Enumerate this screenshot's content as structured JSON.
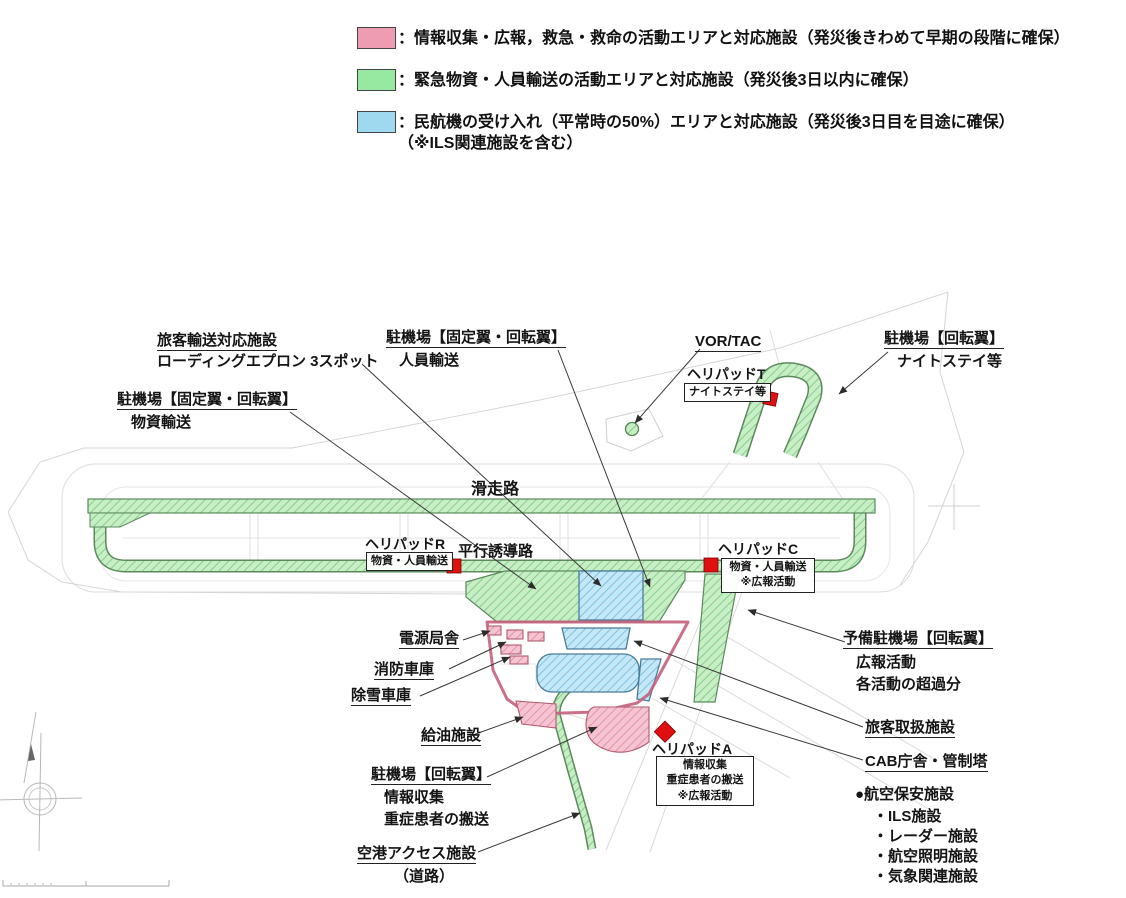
{
  "colors": {
    "pink": "#ee9cb2",
    "green": "#97e8a0",
    "blue": "#9ed9f0",
    "red": "#e01010",
    "boundary": "#c4607c"
  },
  "legend": {
    "items": [
      {
        "color": "#ee9cb2",
        "label": "：情報収集・広報，救急・救命の活動エリアと対応施設（発災後きわめて早期の段階に確保）"
      },
      {
        "color": "#97e8a0",
        "label": "：緊急物資・人員輸送の活動エリアと対応施設（発災後3日以内に確保）"
      },
      {
        "color": "#9ed9f0",
        "label": "：民航機の受け入れ（平常時の50%）エリアと対応施設（発災後3日目を目途に確保）",
        "label2": "（※ILS関連施設を含む）"
      }
    ]
  },
  "map": {
    "labels": {
      "runway": "滑走路",
      "taxiway": "平行誘導路",
      "loading1": "旅客輸送対応施設",
      "loading2": "ローディングエプロン 3スポット",
      "apron_fixed": "駐機場【固定翼・回転翼】",
      "jinin": "人員輸送",
      "busshi": "物資輸送",
      "vortac": "VOR/TAC",
      "apron_rotary": "駐機場【回転翼】",
      "nightstay": "ナイトステイ等",
      "helipad_t": "ヘリパッドT",
      "helipad_r": "ヘリパッドR",
      "helipad_c": "ヘリパッドC",
      "helipad_a": "ヘリパッドA",
      "busshi_jinin": "物資・人員輸送",
      "koho": "※広報活動",
      "joho": "情報収集",
      "jusho": "重症患者の搬送",
      "yobi1": "予備駐機場【回転翼】",
      "yobi2": "広報活動",
      "yobi3": "各活動の超過分",
      "dengen": "電源局舎",
      "shobo": "消防車庫",
      "josetsu": "除雪車庫",
      "kyuyu": "給油施設",
      "access1": "空港アクセス施設",
      "access2": "（道路）",
      "passenger": "旅客取扱施設",
      "cab": "CAB庁舎・管制塔"
    },
    "security": {
      "title": "●航空保安施設",
      "items": [
        "・ILS施設",
        "・レーダー施設",
        "・航空照明施設",
        "・気象関連施設"
      ]
    }
  }
}
